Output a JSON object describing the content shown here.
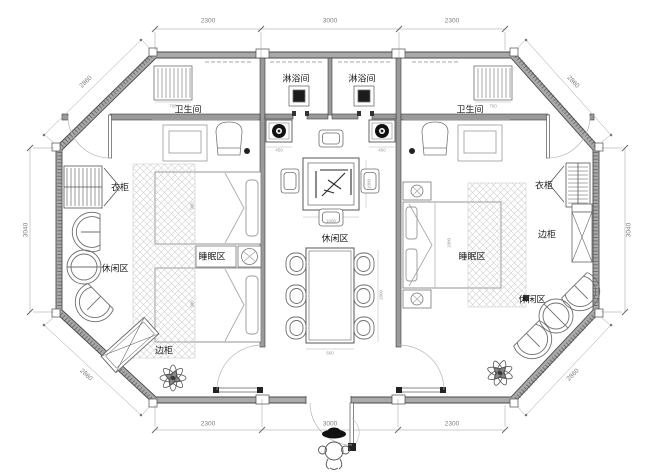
{
  "title": "octagonal-twin-suite-floor-plan",
  "colors": {
    "background": "#ffffff",
    "wall_fill": "#a9a9a9",
    "line": "#4a4a4a",
    "dim": "#8c8c8c",
    "hatch": "#cccccc",
    "dark_fill": "#1c1c1c"
  },
  "rooms": {
    "shower_left": "淋浴间",
    "shower_right": "淋浴间",
    "bathroom_left": "卫生间",
    "bathroom_right": "卫生间",
    "wardrobe_left": "衣柜",
    "wardrobe_right": "衣柜",
    "sleeping_left": "睡眠区",
    "sleeping_right": "睡眠区",
    "leisure_left": "休闲区",
    "leisure_center": "休闲区",
    "leisure_right": "休闲区",
    "side_cabinet_left": "边柜",
    "side_cabinet_right": "边柜"
  },
  "dimensions": {
    "top": [
      "2300",
      "3000",
      "2300"
    ],
    "bottom": [
      "2300",
      "3000",
      "2300"
    ],
    "left": "3040",
    "right": "3040",
    "diag_top_left": "2860",
    "diag_top_right": "2860",
    "diag_bottom_left": "2860",
    "diag_bottom_right": "2860",
    "minor": {
      "shelf_left": "700",
      "shelf_right": "700",
      "bath_left_a": "1200",
      "bath_left_b": "1100",
      "bath_right_a": "1100",
      "bath_right_b": "1200",
      "basin_left": "450",
      "basin_right": "450",
      "table_width": "1000",
      "table_height": "1000",
      "dining_width": "600",
      "dining_height": "1800",
      "bed_left_a": "900",
      "bed_left_b": "900",
      "bed_right": "1800"
    }
  }
}
